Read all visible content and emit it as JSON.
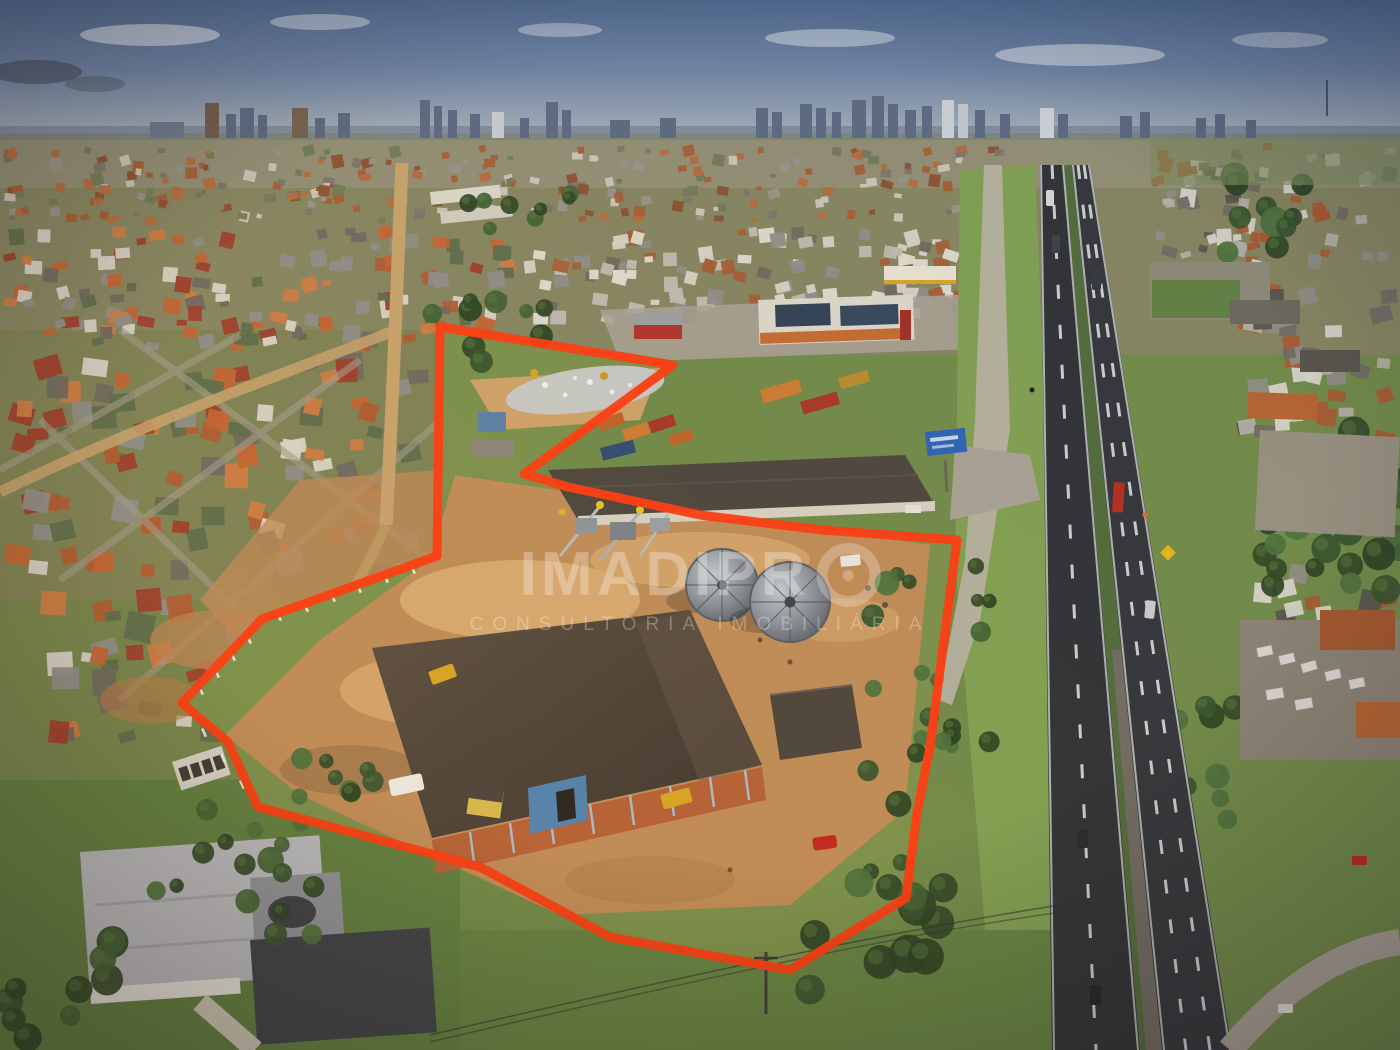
{
  "image_type": "aerial-drone-photograph",
  "scene_summary": "Aerial drone photo of an industrial lot with silos and a brick warehouse, outlined in red, beside a divided highway with a city skyline on the horizon",
  "watermark": {
    "brand_main": "IMADIPR",
    "brand_o_glyph": "O",
    "subtitle": "CONSULTORIA IMOBILIÁRIA"
  },
  "annotation": {
    "boundary_color": "#ff3a0e",
    "boundary_stroke_width": 9,
    "boundary_points": "440,327 673,365 524,474 568,487 700,515 822,530 957,540 930,747 917,813 906,898 790,970 610,937 480,867 258,807 228,742 182,703 262,619 437,556 440,327"
  },
  "palette": {
    "sky_top": "#4d688f",
    "sky_horizon": "#c7c8bb",
    "boundary_red": "#ff3a0e",
    "grass": "#6f8a46",
    "dirt_yard": "#c08b55",
    "asphalt": "#2e3135",
    "terracotta_roof": "#b05a2e",
    "warehouse_roof": "#4d443a",
    "brick_wall": "#b55f33",
    "silo_steel": "#8e959b",
    "watermark_white": "rgba(255,255,255,0.28)"
  },
  "scene": {
    "palettes": {
      "distant": [
        "#a55c31",
        "#b46a3a",
        "#97948b",
        "#7a7468",
        "#cdc8ba",
        "#6f7a55",
        "#8a4f2e"
      ],
      "neighborhood": [
        "#b05a2e",
        "#c4622f",
        "#d07a3f",
        "#8d8d88",
        "#6e675e",
        "#dad5c8",
        "#5c6b49",
        "#9e3c28"
      ],
      "commercial": [
        "#d8d4c6",
        "#c0bdb2",
        "#a55c31",
        "#8d8d88",
        "#6e675e",
        "#e2ded2"
      ],
      "industrial": [
        "#8f8c84",
        "#6e6a62",
        "#b3b0a6",
        "#a8582e",
        "#d8d5cc",
        "#55524a"
      ],
      "greens": [
        "#33512a",
        "#3e6030",
        "#2c4522",
        "#49703a",
        "#274020"
      ]
    },
    "house_fields": [
      {
        "x": 0,
        "y": 146,
        "w": 1020,
        "h": 78,
        "n": 240,
        "min": 5,
        "max": 12,
        "seed": 11,
        "pal": "distant"
      },
      {
        "x": 0,
        "y": 226,
        "w": 520,
        "h": 125,
        "n": 130,
        "min": 9,
        "max": 18,
        "seed": 22,
        "pal": "neighborhood"
      },
      {
        "x": 520,
        "y": 226,
        "w": 450,
        "h": 100,
        "n": 110,
        "min": 8,
        "max": 16,
        "seed": 33,
        "pal": "commercial"
      },
      {
        "x": 0,
        "y": 352,
        "w": 430,
        "h": 230,
        "n": 95,
        "min": 13,
        "max": 26,
        "seed": 44,
        "pal": "neighborhood"
      },
      {
        "x": 30,
        "y": 585,
        "w": 280,
        "h": 185,
        "n": 42,
        "min": 14,
        "max": 28,
        "seed": 55,
        "pal": "neighborhood"
      },
      {
        "x": 1150,
        "y": 142,
        "w": 250,
        "h": 128,
        "n": 70,
        "min": 8,
        "max": 16,
        "seed": 66,
        "pal": "industrial"
      },
      {
        "x": 1235,
        "y": 282,
        "w": 165,
        "h": 165,
        "n": 42,
        "min": 12,
        "max": 22,
        "seed": 77,
        "pal": "industrial"
      },
      {
        "x": 1245,
        "y": 560,
        "w": 155,
        "h": 195,
        "n": 34,
        "min": 12,
        "max": 24,
        "seed": 88,
        "pal": "industrial"
      }
    ],
    "tree_fields": [
      {
        "x": 868,
        "y": 565,
        "w": 70,
        "h": 320,
        "n": 13,
        "rmin": 7,
        "rmax": 14,
        "seed": 101
      },
      {
        "x": 788,
        "y": 875,
        "w": 170,
        "h": 115,
        "n": 12,
        "rmin": 10,
        "rmax": 20,
        "seed": 102
      },
      {
        "x": 1222,
        "y": 172,
        "w": 85,
        "h": 95,
        "n": 10,
        "rmin": 9,
        "rmax": 16,
        "seed": 103
      },
      {
        "x": 1348,
        "y": 415,
        "w": 52,
        "h": 175,
        "n": 10,
        "rmin": 9,
        "rmax": 18,
        "seed": 104
      },
      {
        "x": 935,
        "y": 558,
        "w": 55,
        "h": 200,
        "n": 11,
        "rmin": 6,
        "rmax": 11,
        "seed": 105
      },
      {
        "x": 150,
        "y": 808,
        "w": 230,
        "h": 130,
        "n": 16,
        "rmin": 7,
        "rmax": 14,
        "seed": 106
      },
      {
        "x": 420,
        "y": 298,
        "w": 150,
        "h": 70,
        "n": 9,
        "rmin": 7,
        "rmax": 12,
        "seed": 107
      },
      {
        "x": 1238,
        "y": 518,
        "w": 95,
        "h": 90,
        "n": 8,
        "rmin": 9,
        "rmax": 15,
        "seed": 108
      },
      {
        "x": 275,
        "y": 745,
        "w": 120,
        "h": 60,
        "n": 8,
        "rmin": 6,
        "rmax": 11,
        "seed": 109
      },
      {
        "x": 1155,
        "y": 695,
        "w": 85,
        "h": 125,
        "n": 8,
        "rmin": 8,
        "rmax": 14,
        "seed": 110
      },
      {
        "x": 0,
        "y": 930,
        "w": 140,
        "h": 120,
        "n": 10,
        "rmin": 9,
        "rmax": 16,
        "seed": 111
      },
      {
        "x": 455,
        "y": 188,
        "w": 120,
        "h": 55,
        "n": 8,
        "rmin": 6,
        "rmax": 10,
        "seed": 112
      }
    ],
    "fence_posts": [
      [
        410,
        566
      ],
      [
        383,
        575
      ],
      [
        356,
        585
      ],
      [
        330,
        594
      ],
      [
        303,
        604
      ],
      [
        276,
        613
      ],
      [
        246,
        636
      ],
      [
        230,
        653
      ],
      [
        214,
        670
      ],
      [
        198,
        687
      ],
      [
        201,
        729
      ],
      [
        220,
        755
      ],
      [
        239,
        781
      ]
    ]
  }
}
